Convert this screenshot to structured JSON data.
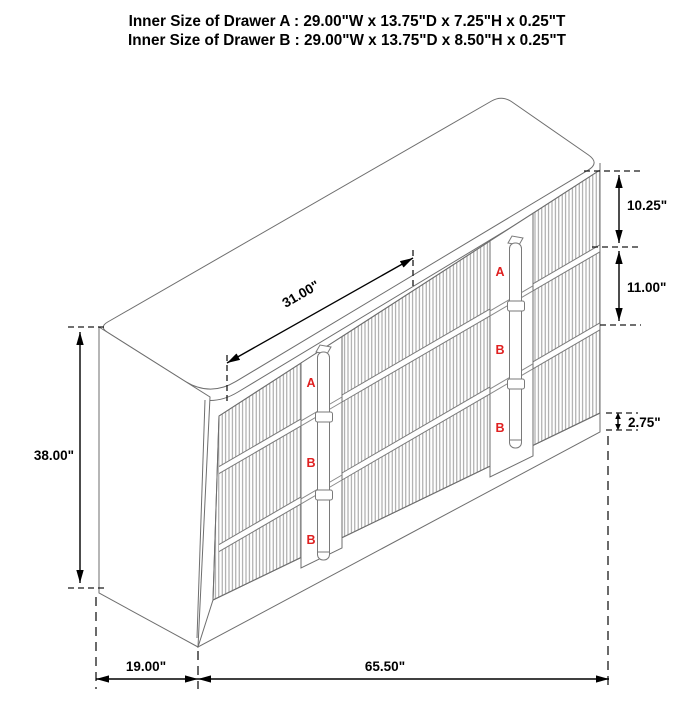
{
  "title": {
    "line1": "Inner Size of Drawer A : 29.00\"W x 13.75\"D x 7.25\"H x 0.25\"T",
    "line2": "Inner Size of Drawer B : 29.00\"W x 13.75\"D x 8.50\"H x 0.25\"T"
  },
  "dimensions": {
    "top_width": "31.00\"",
    "drawer_a_front_height": "10.25\"",
    "drawer_b_front_height": "11.00\"",
    "base_height": "2.75\"",
    "overall_height": "38.00\"",
    "overall_depth": "19.00\"",
    "overall_width": "65.50\""
  },
  "drawer_markers": {
    "left_handle": [
      "A",
      "B",
      "B"
    ],
    "right_handle": [
      "A",
      "B",
      "B"
    ]
  },
  "colors": {
    "background": "#ffffff",
    "cabinet_line": "#6e6e6e",
    "flute_line": "#979797",
    "dimension_line": "#000000",
    "marker_red": "#e02020"
  }
}
